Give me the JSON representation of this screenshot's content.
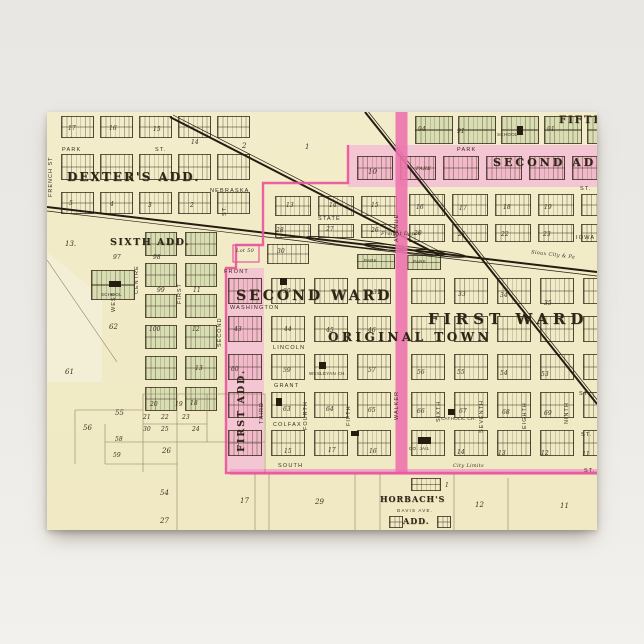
{
  "scene": {
    "background_top": "#e9e7e3",
    "background_bottom": "#f3f1ed"
  },
  "postcard": {
    "x": 47,
    "y": 112,
    "width": 550,
    "height": 418,
    "paper_color": "#f2ecca"
  },
  "map": {
    "colors": {
      "ink": "#382e1d",
      "green": "#d9ddb2",
      "pink_fill": "#f4c5d2",
      "pink_line": "#e9569c",
      "walker_pink": "#ec74ad",
      "rail": "#231c10",
      "city_limits": "#f0a9c6"
    },
    "big_labels": [
      {
        "t": "DEXTER'S ADD.",
        "x": 20,
        "y": 58,
        "s": 12,
        "ls": 2
      },
      {
        "t": "SIXTH ADD.",
        "x": 63,
        "y": 125,
        "s": 9.5,
        "ls": 1.5
      },
      {
        "t": "SECOND WARD",
        "x": 189,
        "y": 176,
        "s": 14,
        "ls": 3
      },
      {
        "t": "ORIGINAL TOWN",
        "x": 281,
        "y": 218,
        "s": 12,
        "ls": 3.5
      },
      {
        "t": "FIRST WARD",
        "x": 381,
        "y": 198,
        "s": 15,
        "ls": 5
      },
      {
        "t": "SECOND ADD.",
        "x": 446,
        "y": 44,
        "s": 11,
        "ls": 3
      },
      {
        "t": "FIFTH ADD.",
        "x": 512,
        "y": 3,
        "s": 10,
        "ls": 2
      },
      {
        "t": "FIRST ADD.",
        "x": 189,
        "y": 340,
        "s": 9.5,
        "ls": 2,
        "v": true
      },
      {
        "t": "HORBACH'S",
        "x": 333,
        "y": 382,
        "s": 8,
        "ls": 1
      },
      {
        "t": "ADD.",
        "x": 356,
        "y": 404,
        "s": 8,
        "ls": 1
      }
    ],
    "street_labels": [
      {
        "t": "PARK",
        "x": 15,
        "y": 35
      },
      {
        "t": "ST.",
        "x": 108,
        "y": 35
      },
      {
        "t": "NEBRASKA",
        "x": 163,
        "y": 76
      },
      {
        "t": "STATE",
        "x": 271,
        "y": 104
      },
      {
        "t": "FRONT",
        "x": 177,
        "y": 157
      },
      {
        "t": "WASHINGTON",
        "x": 183,
        "y": 193
      },
      {
        "t": "LINCOLN",
        "x": 226,
        "y": 233
      },
      {
        "t": "GRANT",
        "x": 227,
        "y": 271
      },
      {
        "t": "COLFAX",
        "x": 226,
        "y": 310
      },
      {
        "t": "SOUTH",
        "x": 231,
        "y": 351
      },
      {
        "t": "PARK",
        "x": 410,
        "y": 35
      },
      {
        "t": "DAVIS AVE.",
        "x": 350,
        "y": 396,
        "s": 4.5
      },
      {
        "t": "ST.",
        "x": 533,
        "y": 74
      },
      {
        "t": "IOWA",
        "x": 529,
        "y": 123
      },
      {
        "t": "ST.",
        "x": 532,
        "y": 279
      },
      {
        "t": "ST.",
        "x": 534,
        "y": 320
      },
      {
        "t": "ST.",
        "x": 537,
        "y": 356
      }
    ],
    "street_labels_vertical": [
      {
        "t": "FRENCH ST",
        "x": 1,
        "y": 85
      },
      {
        "t": "WEST",
        "x": 64,
        "y": 200
      },
      {
        "t": "CENTRE",
        "x": 87,
        "y": 182
      },
      {
        "t": "FIRST",
        "x": 130,
        "y": 192
      },
      {
        "t": "SECOND",
        "x": 170,
        "y": 235
      },
      {
        "t": "ST.",
        "x": 175,
        "y": 104
      },
      {
        "t": "THIRD",
        "x": 212,
        "y": 312
      },
      {
        "t": "FOURTH",
        "x": 256,
        "y": 318
      },
      {
        "t": "FIFTH",
        "x": 299,
        "y": 314
      },
      {
        "t": "WALKER",
        "x": 347,
        "y": 308
      },
      {
        "t": "AVENUE",
        "x": 347,
        "y": 130
      },
      {
        "t": "SIXTH",
        "x": 389,
        "y": 310
      },
      {
        "t": "SEVENTH",
        "x": 432,
        "y": 321
      },
      {
        "t": "EIGHTH",
        "x": 475,
        "y": 317
      },
      {
        "t": "NINTH",
        "x": 517,
        "y": 312
      }
    ],
    "small_labels": [
      {
        "t": "SCHOOL",
        "x": 54,
        "y": 180
      },
      {
        "t": "SCHOOL",
        "x": 450,
        "y": 20
      },
      {
        "t": "CO. JAIL",
        "x": 362,
        "y": 334
      },
      {
        "t": "CATHOLIC CH.",
        "x": 394,
        "y": 304
      },
      {
        "t": "WESLEYAN CH.",
        "x": 262,
        "y": 259
      },
      {
        "t": "PARK",
        "x": 317,
        "y": 146
      },
      {
        "t": "PARK",
        "x": 366,
        "y": 147
      },
      {
        "t": "PARK",
        "x": 369,
        "y": 54,
        "i": true
      },
      {
        "t": "Freight Depot",
        "x": 334,
        "y": 119,
        "i": true
      },
      {
        "t": "City Limits",
        "x": 406,
        "y": 351,
        "i": true
      },
      {
        "t": "Lot 50",
        "x": 189,
        "y": 136,
        "i": true
      },
      {
        "t": "Sioux City & Pa",
        "x": 484,
        "y": 140,
        "i": true,
        "r": 6.8
      }
    ],
    "block_numbers": [
      {
        "t": "17",
        "x": 21,
        "y": 13
      },
      {
        "t": "16",
        "x": 62,
        "y": 13
      },
      {
        "t": "15",
        "x": 106,
        "y": 14
      },
      {
        "t": "14",
        "x": 144,
        "y": 27
      },
      {
        "t": "5",
        "x": 22,
        "y": 88
      },
      {
        "t": "4",
        "x": 63,
        "y": 89
      },
      {
        "t": "3",
        "x": 101,
        "y": 90
      },
      {
        "t": "2",
        "x": 143,
        "y": 90
      },
      {
        "t": "2",
        "x": 195,
        "y": 30,
        "s": 7
      },
      {
        "t": "1",
        "x": 258,
        "y": 31,
        "s": 7
      },
      {
        "t": "10",
        "x": 321,
        "y": 56,
        "s": 7
      },
      {
        "t": "13.",
        "x": 18,
        "y": 128,
        "s": 7
      },
      {
        "t": "94",
        "x": 371,
        "y": 14
      },
      {
        "t": "91",
        "x": 410,
        "y": 16
      },
      {
        "t": "91",
        "x": 500,
        "y": 14
      },
      {
        "t": "16",
        "x": 369,
        "y": 92
      },
      {
        "t": "17",
        "x": 412,
        "y": 93
      },
      {
        "t": "18",
        "x": 456,
        "y": 92
      },
      {
        "t": "19",
        "x": 497,
        "y": 92
      },
      {
        "t": "20",
        "x": 367,
        "y": 118
      },
      {
        "t": "21",
        "x": 411,
        "y": 119
      },
      {
        "t": "22",
        "x": 454,
        "y": 119
      },
      {
        "t": "23",
        "x": 496,
        "y": 119
      },
      {
        "t": "13",
        "x": 239,
        "y": 90
      },
      {
        "t": "14",
        "x": 282,
        "y": 90
      },
      {
        "t": "15",
        "x": 324,
        "y": 90
      },
      {
        "t": "28",
        "x": 229,
        "y": 115
      },
      {
        "t": "27",
        "x": 279,
        "y": 114
      },
      {
        "t": "26",
        "x": 324,
        "y": 115
      },
      {
        "t": "30",
        "x": 230,
        "y": 136
      },
      {
        "t": "39",
        "x": 236,
        "y": 176
      },
      {
        "t": "31",
        "x": 326,
        "y": 177
      },
      {
        "t": "33",
        "x": 411,
        "y": 179
      },
      {
        "t": "34",
        "x": 453,
        "y": 180
      },
      {
        "t": "35",
        "x": 497,
        "y": 188
      },
      {
        "t": "43",
        "x": 187,
        "y": 214
      },
      {
        "t": "44",
        "x": 237,
        "y": 214
      },
      {
        "t": "45",
        "x": 279,
        "y": 215
      },
      {
        "t": "46",
        "x": 321,
        "y": 215
      },
      {
        "t": "60",
        "x": 184,
        "y": 254
      },
      {
        "t": "59",
        "x": 236,
        "y": 255
      },
      {
        "t": "57",
        "x": 321,
        "y": 255
      },
      {
        "t": "56",
        "x": 370,
        "y": 257
      },
      {
        "t": "55",
        "x": 410,
        "y": 257
      },
      {
        "t": "54",
        "x": 453,
        "y": 258
      },
      {
        "t": "53",
        "x": 494,
        "y": 259
      },
      {
        "t": "63",
        "x": 236,
        "y": 294
      },
      {
        "t": "64",
        "x": 279,
        "y": 294
      },
      {
        "t": "65",
        "x": 321,
        "y": 295
      },
      {
        "t": "66",
        "x": 370,
        "y": 296
      },
      {
        "t": "67",
        "x": 412,
        "y": 296
      },
      {
        "t": "68",
        "x": 455,
        "y": 297
      },
      {
        "t": "69",
        "x": 497,
        "y": 298
      },
      {
        "t": "15",
        "x": 237,
        "y": 336
      },
      {
        "t": "17",
        "x": 281,
        "y": 335
      },
      {
        "t": "16",
        "x": 322,
        "y": 336
      },
      {
        "t": "14",
        "x": 410,
        "y": 337
      },
      {
        "t": "13",
        "x": 451,
        "y": 338
      },
      {
        "t": "12",
        "x": 494,
        "y": 338
      },
      {
        "t": "11",
        "x": 535,
        "y": 339
      },
      {
        "t": "97",
        "x": 66,
        "y": 142
      },
      {
        "t": "98",
        "x": 106,
        "y": 142
      },
      {
        "t": "99",
        "x": 110,
        "y": 175
      },
      {
        "t": "100",
        "x": 102,
        "y": 214
      },
      {
        "t": "11",
        "x": 146,
        "y": 175
      },
      {
        "t": "12",
        "x": 145,
        "y": 214
      },
      {
        "t": "13",
        "x": 148,
        "y": 253
      },
      {
        "t": "62",
        "x": 62,
        "y": 211,
        "s": 7
      },
      {
        "t": "61",
        "x": 18,
        "y": 256,
        "s": 7
      },
      {
        "t": "55",
        "x": 68,
        "y": 297,
        "s": 7
      },
      {
        "t": "56",
        "x": 36,
        "y": 312,
        "s": 7
      },
      {
        "t": "58",
        "x": 68,
        "y": 324
      },
      {
        "t": "59",
        "x": 66,
        "y": 340
      },
      {
        "t": "26",
        "x": 115,
        "y": 335,
        "s": 7
      },
      {
        "t": "54",
        "x": 113,
        "y": 377,
        "s": 7
      },
      {
        "t": "27",
        "x": 113,
        "y": 405,
        "s": 7
      },
      {
        "t": "20",
        "x": 103,
        "y": 289
      },
      {
        "t": "19",
        "x": 128,
        "y": 289
      },
      {
        "t": "18",
        "x": 143,
        "y": 288
      },
      {
        "t": "21",
        "x": 96,
        "y": 302
      },
      {
        "t": "22",
        "x": 114,
        "y": 302
      },
      {
        "t": "23",
        "x": 135,
        "y": 302
      },
      {
        "t": "30",
        "x": 96,
        "y": 314
      },
      {
        "t": "25",
        "x": 114,
        "y": 314
      },
      {
        "t": "24",
        "x": 145,
        "y": 314
      },
      {
        "t": "17",
        "x": 193,
        "y": 385,
        "s": 7
      },
      {
        "t": "29",
        "x": 268,
        "y": 386,
        "s": 7
      },
      {
        "t": "12",
        "x": 428,
        "y": 389,
        "s": 7
      },
      {
        "t": "11",
        "x": 513,
        "y": 390,
        "s": 7
      },
      {
        "t": "1",
        "x": 398,
        "y": 370
      }
    ],
    "buildings": [
      {
        "x": 470,
        "y": 14,
        "w": 6,
        "h": 9
      },
      {
        "x": 62,
        "y": 169,
        "w": 12,
        "h": 6
      },
      {
        "x": 371,
        "y": 325,
        "w": 13,
        "h": 7
      },
      {
        "x": 401,
        "y": 297,
        "w": 7,
        "h": 6
      },
      {
        "x": 272,
        "y": 250,
        "w": 7,
        "h": 7
      },
      {
        "x": 233,
        "y": 166,
        "w": 7,
        "h": 7
      },
      {
        "x": 229,
        "y": 286,
        "w": 6,
        "h": 8
      },
      {
        "x": 304,
        "y": 319,
        "w": 8,
        "h": 5
      }
    ]
  }
}
